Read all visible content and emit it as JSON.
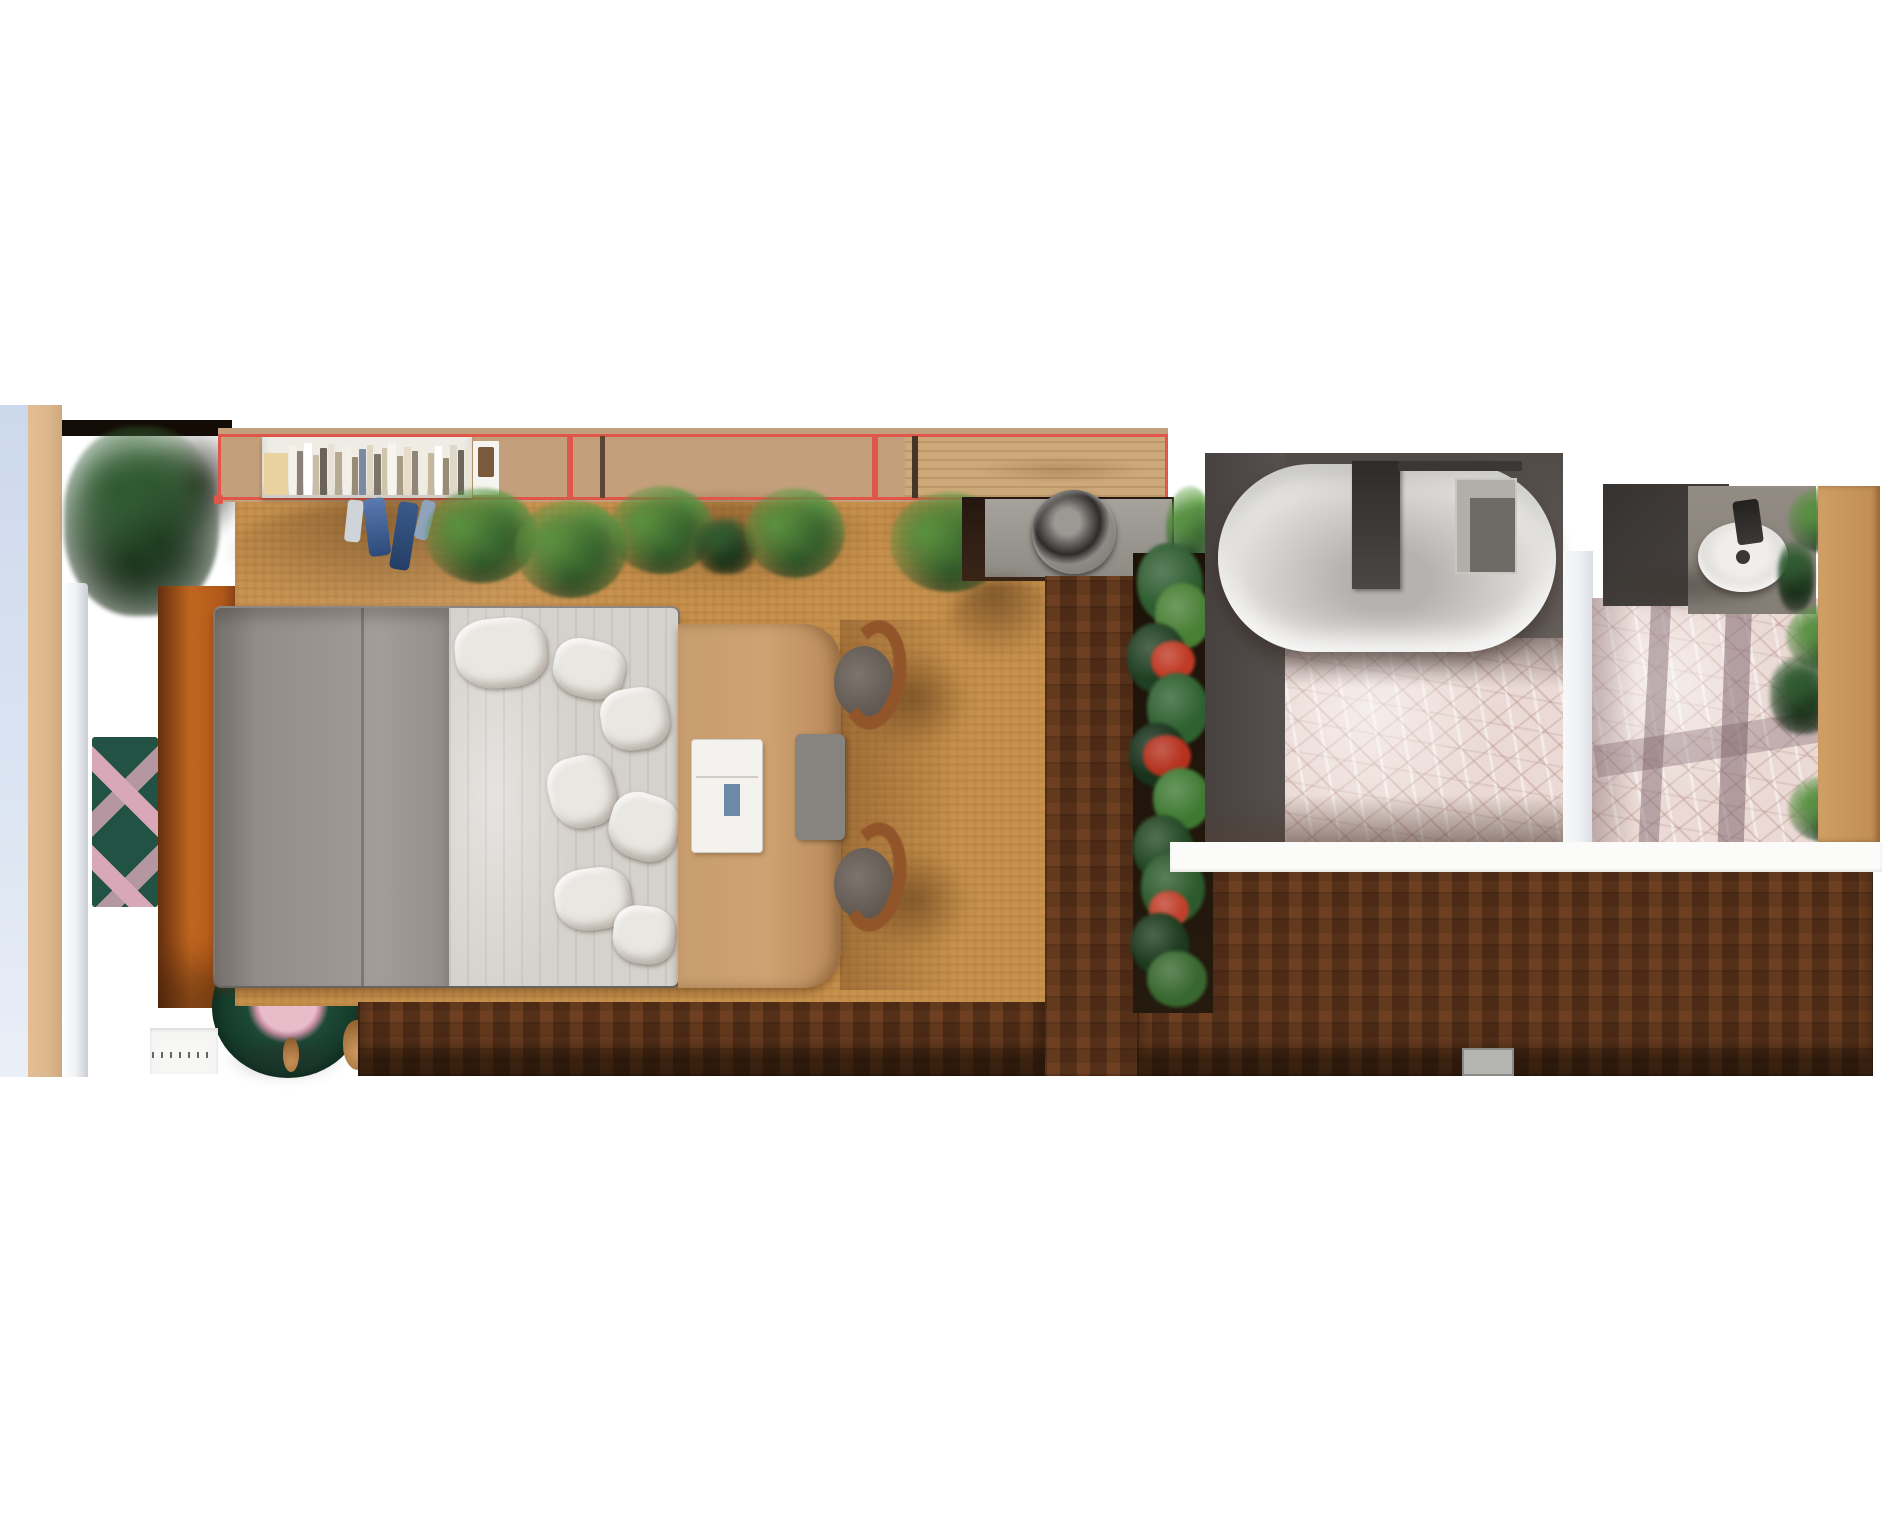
{
  "scene": {
    "name": "apartment-floor-plan-top-view",
    "view": "2d-top-down-render",
    "selection": {
      "target": "wall-shelf-row",
      "segment_count": 3,
      "color": "#e0564a"
    }
  },
  "objects": {
    "balcony_glass": "balcony-window-glass",
    "entry_plant": "potted-monstera-plant",
    "wardrobe": "orange-wardrobe-cabinet",
    "chevron_rug": "green-pink-chevron-runner-rug",
    "round_rug": "round-green-rug-with-pink-center",
    "bookshelf": "wall-shelf-with-books",
    "countertop": "wood-counter-shelf",
    "clothes": "hanging-blue-clothes",
    "washer": "washing-machine-top",
    "bed": "double-bed-gray-duvet-white-sheets",
    "desk": "wood-desk-table",
    "laptop": "white-laptop-on-desk",
    "chair_1": "wood-chair-1",
    "chair_2": "wood-chair-2",
    "planter": "vertical-planter-with-red-flowers",
    "bathtub": "oval-bathtub",
    "tub_bench": "bath-bench",
    "sink": "oval-washbasin",
    "powder_plants": "bathroom-plants",
    "floor_bedroom": "cork-floor",
    "floor_hall": "dark-parquet-floor",
    "floor_bath": "pink-mosaic-tile-floor",
    "mat": "gray-doormat"
  },
  "colors": {
    "select-red": "#e0564a",
    "cork": "#c7914d",
    "parquet": "#56311b",
    "mosaic": "#ead9d4",
    "glass-blue": "#ccd8ec",
    "wall-tan": "#dcb68c",
    "entry-dark": "#33200f",
    "wardrobe-orange": "#b55a1c",
    "duvet-gray": "#97908b",
    "sheet-white": "#d5d1cc",
    "desk-wood": "#c79d6e",
    "deck-gray": "#5d5754",
    "tub-white": "#f2f1ef",
    "leaf-light": "#57923f",
    "leaf-mid": "#2f5d2a",
    "leaf-dark": "#1d3b1e",
    "flower-red": "#c03a26",
    "divider-white": "#eef0f2"
  },
  "books": {
    "items": [
      {
        "c": "#e9d2a0",
        "w": 24,
        "h": 42
      },
      {
        "c": "#f5f2ea",
        "w": 7,
        "h": 50
      },
      {
        "c": "#8a8278",
        "w": 6,
        "h": 44
      },
      {
        "c": "#ffffff",
        "w": 8,
        "h": 52
      },
      {
        "c": "#c9bda6",
        "w": 6,
        "h": 40
      },
      {
        "c": "#6b6258",
        "w": 7,
        "h": 47
      },
      {
        "c": "#e8e2d4",
        "w": 6,
        "h": 51
      },
      {
        "c": "#b7aa92",
        "w": 7,
        "h": 43
      },
      {
        "c": "#f2efe8",
        "w": 8,
        "h": 49
      },
      {
        "c": "#978b76",
        "w": 6,
        "h": 38
      },
      {
        "c": "#7a8aa0",
        "w": 7,
        "h": 46
      },
      {
        "c": "#ded6c2",
        "w": 6,
        "h": 50
      },
      {
        "c": "#7e756a",
        "w": 7,
        "h": 41
      },
      {
        "c": "#cfc5ae",
        "w": 5,
        "h": 47
      },
      {
        "c": "#f7f4ee",
        "w": 8,
        "h": 52
      },
      {
        "c": "#a89b84",
        "w": 6,
        "h": 39
      },
      {
        "c": "#e5ddc9",
        "w": 7,
        "h": 48
      },
      {
        "c": "#8f8678",
        "w": 6,
        "h": 44
      },
      {
        "c": "#f0ece2",
        "w": 8,
        "h": 51
      },
      {
        "c": "#c4b89f",
        "w": 6,
        "h": 42
      },
      {
        "c": "#ffffff",
        "w": 7,
        "h": 49
      },
      {
        "c": "#9a8d75",
        "w": 6,
        "h": 37
      },
      {
        "c": "#ded8cb",
        "w": 7,
        "h": 50
      },
      {
        "c": "#6f665c",
        "w": 6,
        "h": 45
      },
      {
        "c": "#e9e4d8",
        "w": 7,
        "h": 48
      },
      {
        "c": "#f6f4f0",
        "w": 26,
        "h": 54,
        "frame": "#7b5a3c"
      }
    ]
  },
  "planter": {
    "blobs": [
      {
        "x": 4,
        "y": -10,
        "w": 66,
        "h": 80,
        "c": "#2e5c30"
      },
      {
        "x": 22,
        "y": 30,
        "w": 56,
        "h": 66,
        "c": "#497f35"
      },
      {
        "x": -6,
        "y": 70,
        "w": 60,
        "h": 70,
        "c": "#1f3f22"
      },
      {
        "x": 18,
        "y": 88,
        "w": 44,
        "h": 40,
        "c": "#c03a26"
      },
      {
        "x": 14,
        "y": 120,
        "w": 62,
        "h": 72,
        "c": "#2e6030"
      },
      {
        "x": -4,
        "y": 170,
        "w": 58,
        "h": 64,
        "c": "#18321c"
      },
      {
        "x": 10,
        "y": 182,
        "w": 48,
        "h": 42,
        "c": "#b5321f"
      },
      {
        "x": 20,
        "y": 215,
        "w": 58,
        "h": 62,
        "c": "#3f7a33"
      },
      {
        "x": 0,
        "y": 262,
        "w": 60,
        "h": 66,
        "c": "#234724"
      },
      {
        "x": 8,
        "y": 300,
        "w": 64,
        "h": 70,
        "c": "#2c5a2c"
      },
      {
        "x": 16,
        "y": 338,
        "w": 40,
        "h": 36,
        "c": "#c0402c"
      },
      {
        "x": -2,
        "y": 360,
        "w": 58,
        "h": 62,
        "c": "#1c3a1e"
      },
      {
        "x": 14,
        "y": 398,
        "w": 60,
        "h": 56,
        "c": "#38682f"
      }
    ]
  }
}
